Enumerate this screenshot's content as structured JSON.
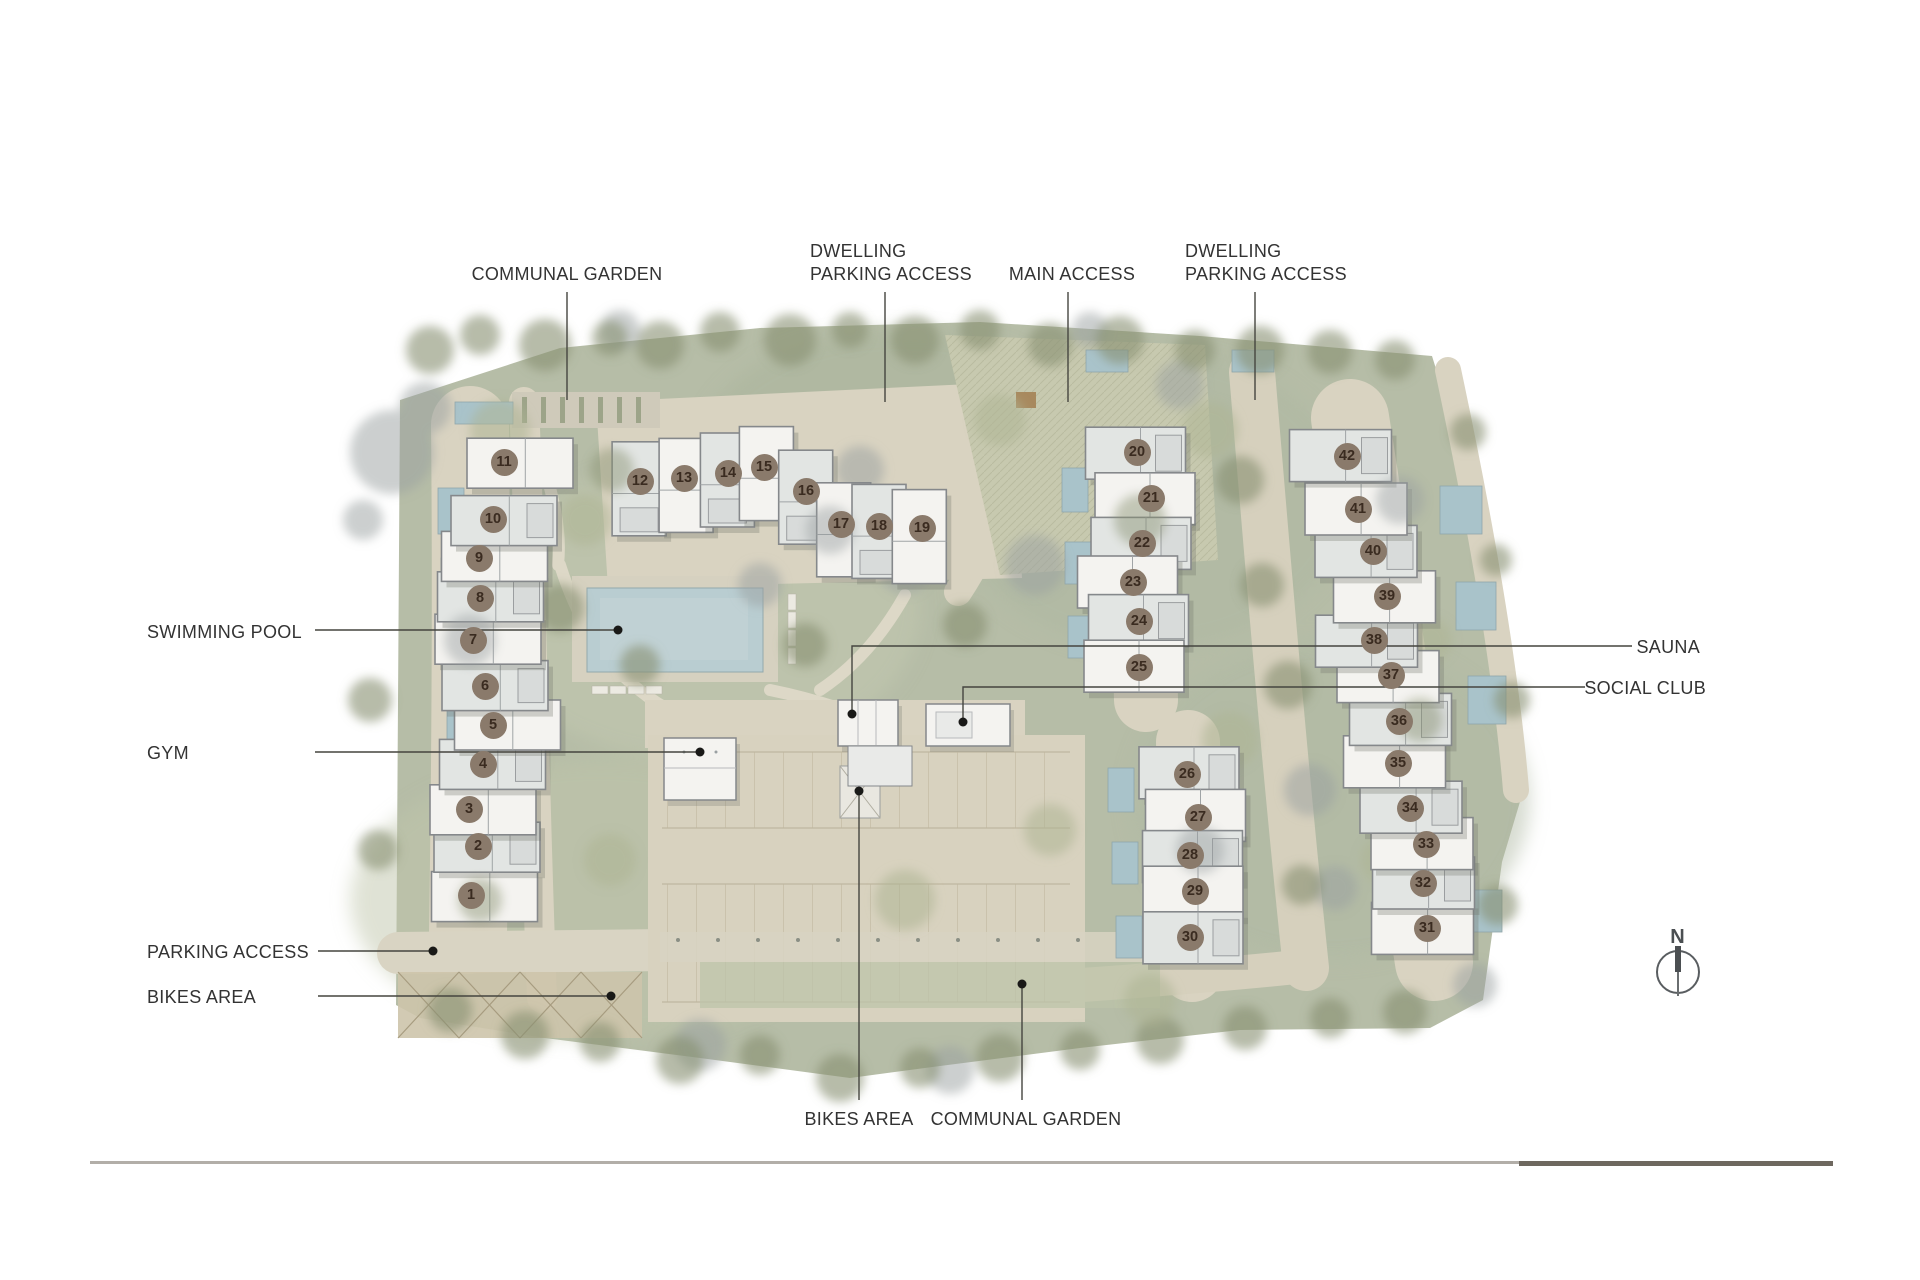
{
  "plan": {
    "compass": {
      "letter": "N"
    },
    "colors": {
      "site_green": "#b6bda7",
      "path_beige": "#d9d3c1",
      "parking": "#d8d2bf",
      "pool_blue": "#b9cdd1",
      "building_white": "#f4f3f0",
      "building_gray": "#e2e5e3",
      "building_stroke": "#85888b",
      "unit_marker": "#8a7a6b",
      "unit_text": "#3a2b20",
      "label_text": "#333333",
      "leader_line": "#45453f",
      "leader_dot": "#191917",
      "scale_light": "#b2aea8",
      "scale_dark": "#6e685f"
    },
    "labels": [
      {
        "id": "communal-garden-top",
        "lines": [
          "COMMUNAL GARDEN"
        ],
        "x": 567,
        "y": 274,
        "anchor": "center",
        "leader": {
          "type": "v",
          "x": 567,
          "y1": 292,
          "y2": 400,
          "dot": false
        }
      },
      {
        "id": "dwelling-parking-access-left",
        "lines": [
          "DWELLING",
          "PARKING ACCESS"
        ],
        "x": 810,
        "y": 251,
        "anchor": "left",
        "leader": {
          "type": "v",
          "x": 885,
          "y1": 292,
          "y2": 402,
          "dot": false
        }
      },
      {
        "id": "main-access",
        "lines": [
          "MAIN ACCESS"
        ],
        "x": 1072,
        "y": 274,
        "anchor": "center",
        "leader": {
          "type": "v",
          "x": 1068,
          "y1": 292,
          "y2": 402,
          "dot": false
        }
      },
      {
        "id": "dwelling-parking-access-right",
        "lines": [
          "DWELLING",
          "PARKING ACCESS"
        ],
        "x": 1185,
        "y": 251,
        "anchor": "left",
        "leader": {
          "type": "v",
          "x": 1255,
          "y1": 292,
          "y2": 400,
          "dot": false
        }
      },
      {
        "id": "swimming-pool",
        "lines": [
          "SWIMMING POOL"
        ],
        "x": 147,
        "y": 632,
        "anchor": "left",
        "leader": {
          "type": "h",
          "y": 630,
          "x1": 315,
          "x2": 618,
          "dot": true
        }
      },
      {
        "id": "gym",
        "lines": [
          "GYM"
        ],
        "x": 147,
        "y": 753,
        "anchor": "left",
        "leader": {
          "type": "h",
          "y": 752,
          "x1": 315,
          "x2": 700,
          "dot": true
        }
      },
      {
        "id": "sauna",
        "lines": [
          "SAUNA"
        ],
        "x": 1700,
        "y": 647,
        "anchor": "right",
        "leader": {
          "type": "hv",
          "y": 646,
          "x1": 1632,
          "x2": 852,
          "y2": 714,
          "dot": true
        }
      },
      {
        "id": "social-club",
        "lines": [
          "SOCIAL CLUB"
        ],
        "x": 1706,
        "y": 688,
        "anchor": "right",
        "leader": {
          "type": "hv",
          "y": 687,
          "x1": 1585,
          "x2": 963,
          "y2": 722,
          "dot": true
        }
      },
      {
        "id": "parking-access",
        "lines": [
          "PARKING ACCESS"
        ],
        "x": 147,
        "y": 952,
        "anchor": "left",
        "leader": {
          "type": "h",
          "y": 951,
          "x1": 318,
          "x2": 433,
          "dot": true
        }
      },
      {
        "id": "bikes-area-left",
        "lines": [
          "BIKES AREA"
        ],
        "x": 147,
        "y": 997,
        "anchor": "left",
        "leader": {
          "type": "h",
          "y": 996,
          "x1": 318,
          "x2": 611,
          "dot": true
        }
      },
      {
        "id": "bikes-area-bottom",
        "lines": [
          "BIKES AREA"
        ],
        "x": 859,
        "y": 1119,
        "anchor": "center",
        "leader": {
          "type": "v",
          "x": 859,
          "y1": 1100,
          "y2": 791,
          "dot": true
        }
      },
      {
        "id": "communal-garden-bottom",
        "lines": [
          "COMMUNAL GARDEN"
        ],
        "x": 1026,
        "y": 1119,
        "anchor": "center",
        "leader": {
          "type": "v",
          "x": 1022,
          "y1": 1100,
          "y2": 984,
          "dot": true
        }
      }
    ],
    "units": [
      {
        "n": "1",
        "cluster": "A",
        "x": 471,
        "y": 895
      },
      {
        "n": "2",
        "cluster": "A",
        "x": 478,
        "y": 846
      },
      {
        "n": "3",
        "cluster": "A",
        "x": 469,
        "y": 809
      },
      {
        "n": "4",
        "cluster": "A",
        "x": 483,
        "y": 764
      },
      {
        "n": "5",
        "cluster": "A",
        "x": 493,
        "y": 725
      },
      {
        "n": "6",
        "cluster": "A",
        "x": 485,
        "y": 686
      },
      {
        "n": "7",
        "cluster": "A",
        "x": 473,
        "y": 640
      },
      {
        "n": "8",
        "cluster": "A",
        "x": 480,
        "y": 598
      },
      {
        "n": "9",
        "cluster": "A",
        "x": 479,
        "y": 558
      },
      {
        "n": "10",
        "cluster": "A",
        "x": 493,
        "y": 519
      },
      {
        "n": "11",
        "cluster": "A",
        "x": 504,
        "y": 462
      },
      {
        "n": "12",
        "cluster": "B",
        "x": 640,
        "y": 481
      },
      {
        "n": "13",
        "cluster": "B",
        "x": 684,
        "y": 478
      },
      {
        "n": "14",
        "cluster": "B",
        "x": 728,
        "y": 473
      },
      {
        "n": "15",
        "cluster": "B",
        "x": 764,
        "y": 467
      },
      {
        "n": "16",
        "cluster": "B",
        "x": 806,
        "y": 491
      },
      {
        "n": "17",
        "cluster": "B",
        "x": 841,
        "y": 524
      },
      {
        "n": "18",
        "cluster": "B",
        "x": 879,
        "y": 526
      },
      {
        "n": "19",
        "cluster": "B",
        "x": 922,
        "y": 528
      },
      {
        "n": "20",
        "cluster": "C",
        "x": 1137,
        "y": 452
      },
      {
        "n": "21",
        "cluster": "C",
        "x": 1151,
        "y": 498
      },
      {
        "n": "22",
        "cluster": "C",
        "x": 1142,
        "y": 543
      },
      {
        "n": "23",
        "cluster": "C",
        "x": 1133,
        "y": 582
      },
      {
        "n": "24",
        "cluster": "C",
        "x": 1139,
        "y": 621
      },
      {
        "n": "25",
        "cluster": "C",
        "x": 1139,
        "y": 667
      },
      {
        "n": "26",
        "cluster": "D",
        "x": 1187,
        "y": 774
      },
      {
        "n": "27",
        "cluster": "D",
        "x": 1198,
        "y": 817
      },
      {
        "n": "28",
        "cluster": "D",
        "x": 1190,
        "y": 855
      },
      {
        "n": "29",
        "cluster": "D",
        "x": 1195,
        "y": 891
      },
      {
        "n": "30",
        "cluster": "D",
        "x": 1190,
        "y": 937
      },
      {
        "n": "31",
        "cluster": "E",
        "x": 1427,
        "y": 928
      },
      {
        "n": "32",
        "cluster": "E",
        "x": 1423,
        "y": 883
      },
      {
        "n": "33",
        "cluster": "E",
        "x": 1426,
        "y": 844
      },
      {
        "n": "34",
        "cluster": "E",
        "x": 1410,
        "y": 808
      },
      {
        "n": "35",
        "cluster": "E",
        "x": 1398,
        "y": 763
      },
      {
        "n": "36",
        "cluster": "E",
        "x": 1399,
        "y": 721
      },
      {
        "n": "37",
        "cluster": "E",
        "x": 1391,
        "y": 675
      },
      {
        "n": "38",
        "cluster": "E",
        "x": 1374,
        "y": 640
      },
      {
        "n": "39",
        "cluster": "E",
        "x": 1387,
        "y": 596
      },
      {
        "n": "40",
        "cluster": "E",
        "x": 1373,
        "y": 551
      },
      {
        "n": "41",
        "cluster": "E",
        "x": 1358,
        "y": 509
      },
      {
        "n": "42",
        "cluster": "E",
        "x": 1347,
        "y": 456
      }
    ]
  }
}
